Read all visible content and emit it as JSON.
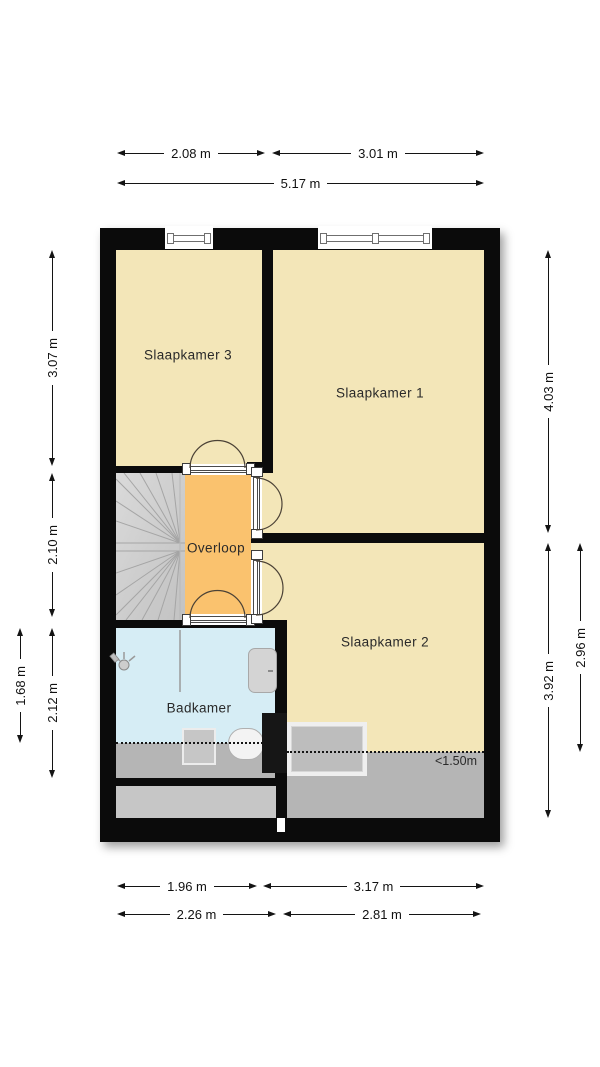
{
  "plan": {
    "type": "floor-plan",
    "floor_label": "verdieping (bedroom floor)",
    "rooms": {
      "slaapkamer3": {
        "label": "Slaapkamer 3",
        "color": "#f3e6b8"
      },
      "slaapkamer1": {
        "label": "Slaapkamer 1",
        "color": "#f3e6b8"
      },
      "slaapkamer2": {
        "label": "Slaapkamer 2",
        "color": "#f3e6b8"
      },
      "overloop": {
        "label": "Overloop",
        "color": "#fac26e"
      },
      "badkamer": {
        "label": "Badkamer",
        "color": "#d6edf5"
      }
    },
    "annotations": {
      "low_headroom": "<1.50m"
    },
    "fixtures": [
      "stairs",
      "shower",
      "washbasin",
      "toilet",
      "radiator",
      "skylight",
      "duct",
      "window",
      "window"
    ],
    "colors": {
      "wall": "#0b0b0b",
      "room_yellow": "#f3e6b8",
      "hall_orange": "#fac26e",
      "bath_blue": "#d6edf5",
      "low_headroom_gray": "#b5b5b5",
      "attic_strip_gray": "#c6c6c6",
      "stairs_gray": "#cfcfcf",
      "background": "#ffffff"
    }
  },
  "dimensions": {
    "top": [
      {
        "label": "2.08 m"
      },
      {
        "label": "3.01 m"
      },
      {
        "label": "5.17 m"
      }
    ],
    "bottom": [
      {
        "label": "1.96 m"
      },
      {
        "label": "3.17 m"
      },
      {
        "label": "2.26 m"
      },
      {
        "label": "2.81 m"
      }
    ],
    "left": [
      {
        "label": "3.07 m"
      },
      {
        "label": "2.10 m"
      },
      {
        "label": "2.12 m"
      },
      {
        "label": "1.68 m"
      }
    ],
    "right": [
      {
        "label": "4.03 m"
      },
      {
        "label": "3.92 m"
      },
      {
        "label": "2.96 m"
      }
    ]
  }
}
